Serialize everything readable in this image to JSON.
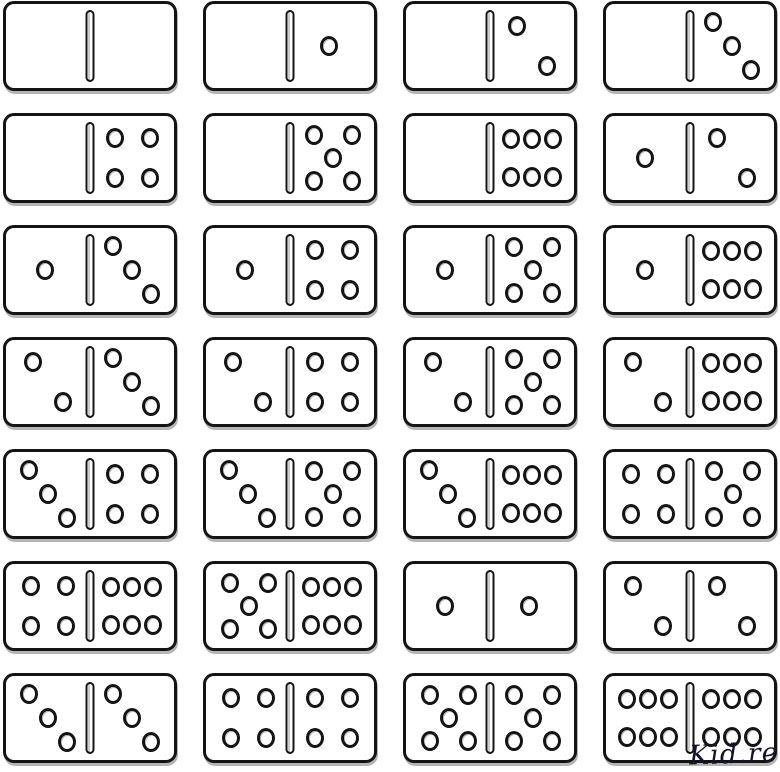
{
  "page": {
    "background": "#ffffff",
    "ink": "#141414",
    "tile_fill": "#ffffff"
  },
  "dominoes": [
    {
      "left": 0,
      "right": 0
    },
    {
      "left": 0,
      "right": 1
    },
    {
      "left": 0,
      "right": 2
    },
    {
      "left": 0,
      "right": 3
    },
    {
      "left": 0,
      "right": 4
    },
    {
      "left": 0,
      "right": 5
    },
    {
      "left": 0,
      "right": 6
    },
    {
      "left": 1,
      "right": 2
    },
    {
      "left": 1,
      "right": 3
    },
    {
      "left": 1,
      "right": 4
    },
    {
      "left": 1,
      "right": 5
    },
    {
      "left": 1,
      "right": 6
    },
    {
      "left": 2,
      "right": 3
    },
    {
      "left": 2,
      "right": 4
    },
    {
      "left": 2,
      "right": 5
    },
    {
      "left": 2,
      "right": 6
    },
    {
      "left": 3,
      "right": 4
    },
    {
      "left": 3,
      "right": 5
    },
    {
      "left": 3,
      "right": 6
    },
    {
      "left": 4,
      "right": 5
    },
    {
      "left": 4,
      "right": 6
    },
    {
      "left": 5,
      "right": 6
    },
    {
      "left": 1,
      "right": 1
    },
    {
      "left": 2,
      "right": 2
    },
    {
      "left": 3,
      "right": 3
    },
    {
      "left": 4,
      "right": 4
    },
    {
      "left": 5,
      "right": 5
    },
    {
      "left": 6,
      "right": 6
    }
  ],
  "pip_layouts": {
    "0": [],
    "1": [
      [
        47,
        50
      ]
    ],
    "2": [
      [
        32,
        26
      ],
      [
        68,
        74
      ]
    ],
    "3": [
      [
        27,
        22
      ],
      [
        50,
        50
      ],
      [
        73,
        78
      ]
    ],
    "4": [
      [
        30,
        26
      ],
      [
        72,
        26
      ],
      [
        30,
        74
      ],
      [
        72,
        74
      ]
    ],
    "5": [
      [
        28,
        23
      ],
      [
        74,
        23
      ],
      [
        51,
        50
      ],
      [
        28,
        77
      ],
      [
        74,
        77
      ]
    ],
    "6": [
      [
        25,
        27
      ],
      [
        50,
        27
      ],
      [
        75,
        27
      ],
      [
        25,
        73
      ],
      [
        50,
        73
      ],
      [
        75,
        73
      ]
    ]
  },
  "watermark": {
    "text": "Kid.re",
    "color": "#14142b"
  }
}
